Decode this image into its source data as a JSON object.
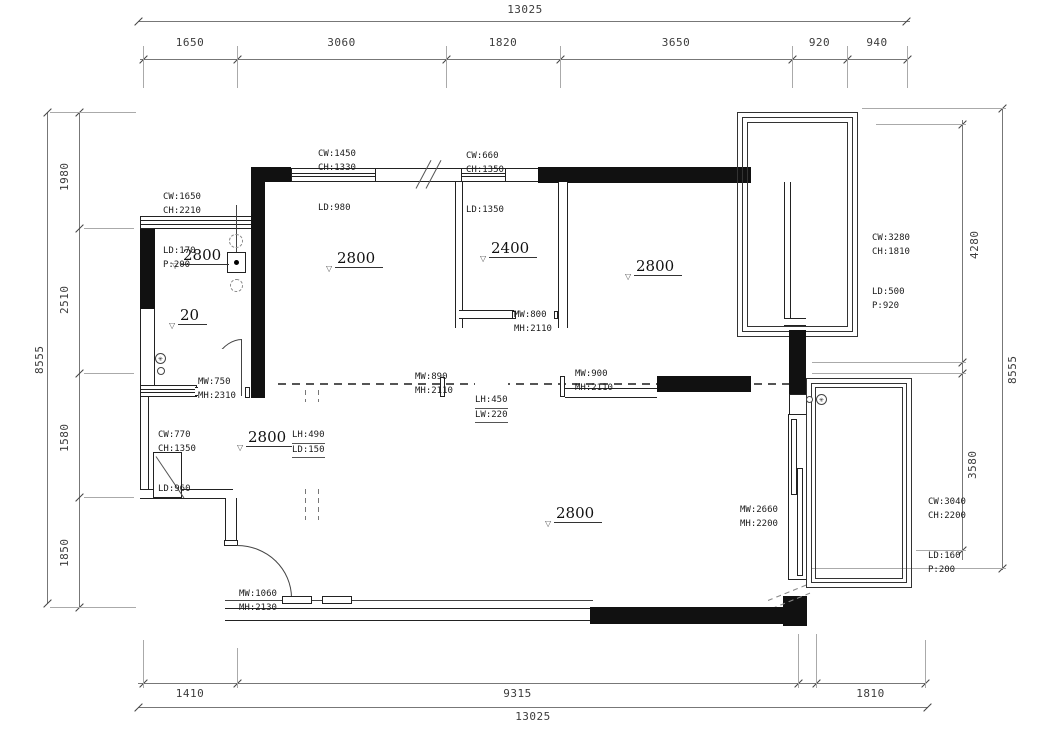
{
  "drawing": {
    "type": "architectural floor plan"
  },
  "dims": {
    "top": {
      "total": "13025",
      "segments": [
        "1650",
        "3060",
        "1820",
        "3650",
        "920",
        "940"
      ]
    },
    "bottom": {
      "total": "13025",
      "segments": [
        "1410",
        "9315",
        "1810"
      ]
    },
    "left": {
      "total": "8555",
      "segments": [
        "1980",
        "2510",
        "1580",
        "1850"
      ]
    },
    "right": {
      "total": "8555",
      "segments": [
        "4280",
        "3580"
      ]
    }
  },
  "rooms": [
    {
      "label": "2800"
    },
    {
      "label": "20"
    },
    {
      "label": "2800"
    },
    {
      "label": "2400"
    },
    {
      "label": "2800"
    },
    {
      "label": "2800"
    },
    {
      "label": "2800"
    }
  ],
  "annotations": [
    {
      "lines": [
        "CW:1650",
        "CH:2210",
        "LD:170",
        "P:200"
      ]
    },
    {
      "lines": [
        "CW:1450",
        "CH:1330",
        "LD:980"
      ]
    },
    {
      "lines": [
        "CW:660",
        "CH:1350",
        "LD:1350"
      ]
    },
    {
      "lines": [
        "CW:3280",
        "CH:1810",
        "LD:500",
        "P:920"
      ]
    },
    {
      "lines": [
        "MW:750",
        "MH:2310"
      ]
    },
    {
      "lines": [
        "MW:800",
        "MH:2110"
      ]
    },
    {
      "lines": [
        "MW:890",
        "MH:2110"
      ]
    },
    {
      "lines": [
        "MW:900",
        "MH:2110"
      ]
    },
    {
      "lines": [
        "LH:450",
        "LW:220"
      ]
    },
    {
      "lines": [
        "LH:490",
        "LD:150"
      ]
    },
    {
      "lines": [
        "CW:770",
        "CH:1350",
        "LD:960"
      ]
    },
    {
      "lines": [
        "MW:2660",
        "MH:2200"
      ]
    },
    {
      "lines": [
        "MW:1060",
        "MH:2130"
      ]
    },
    {
      "lines": [
        "CW:3040",
        "CH:2200",
        "LD:160",
        "P:200"
      ]
    }
  ],
  "glyphs": {
    "room_marker": "▽",
    "fan": "✳"
  },
  "colors": {
    "wall": "#111111",
    "line": "#555555",
    "text": "#333333"
  }
}
